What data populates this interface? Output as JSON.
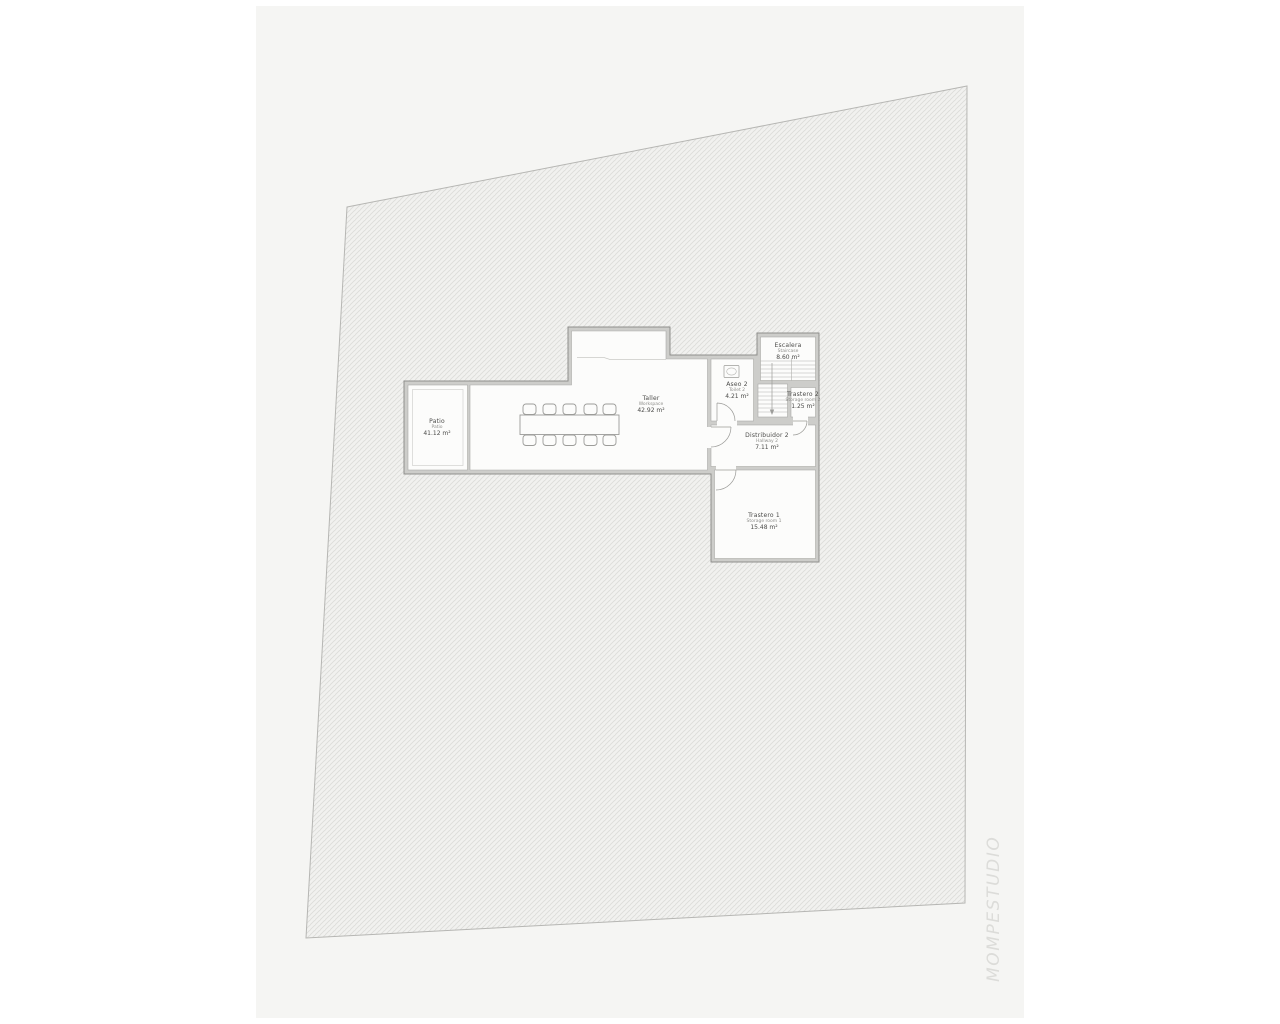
{
  "watermark": "MOMPESTUDIO",
  "rooms": [
    {
      "id": "patio",
      "name": "Patio",
      "subtitle": "Patio",
      "area": "41.12 m²"
    },
    {
      "id": "taller",
      "name": "Taller",
      "subtitle": "Workspace",
      "area": "42.92 m²"
    },
    {
      "id": "aseo-2",
      "name": "Aseo 2",
      "subtitle": "Toilet 2",
      "area": "4.21 m²"
    },
    {
      "id": "escalera",
      "name": "Escalera",
      "subtitle": "Staircase",
      "area": "8.60 m²"
    },
    {
      "id": "trastero-2",
      "name": "Trastero 2",
      "subtitle": "Storage room 2",
      "area": "1.25 m²"
    },
    {
      "id": "distribuidor-2",
      "name": "Distribuidor 2",
      "subtitle": "Hallway 2",
      "area": "7.11 m²"
    },
    {
      "id": "trastero-1",
      "name": "Trastero 1",
      "subtitle": "Storage room 1",
      "area": "15.48 m²"
    }
  ],
  "colors": {
    "page_background": "#ffffff",
    "sheet": "#f5f5f3",
    "hatch_base": "#f1f1ef",
    "hatch_line": "#dcdcd9",
    "lot_outline": "#b6b6b3",
    "wall_fill": "#cdcdca",
    "wall_stroke": "#8f8f8c",
    "room_fill": "#fcfcfb",
    "furniture_stroke": "#9c9c99",
    "label_text": "#4b4b49",
    "label_subtext": "#8f8f8c",
    "watermark_text": "#dcdcd9"
  }
}
